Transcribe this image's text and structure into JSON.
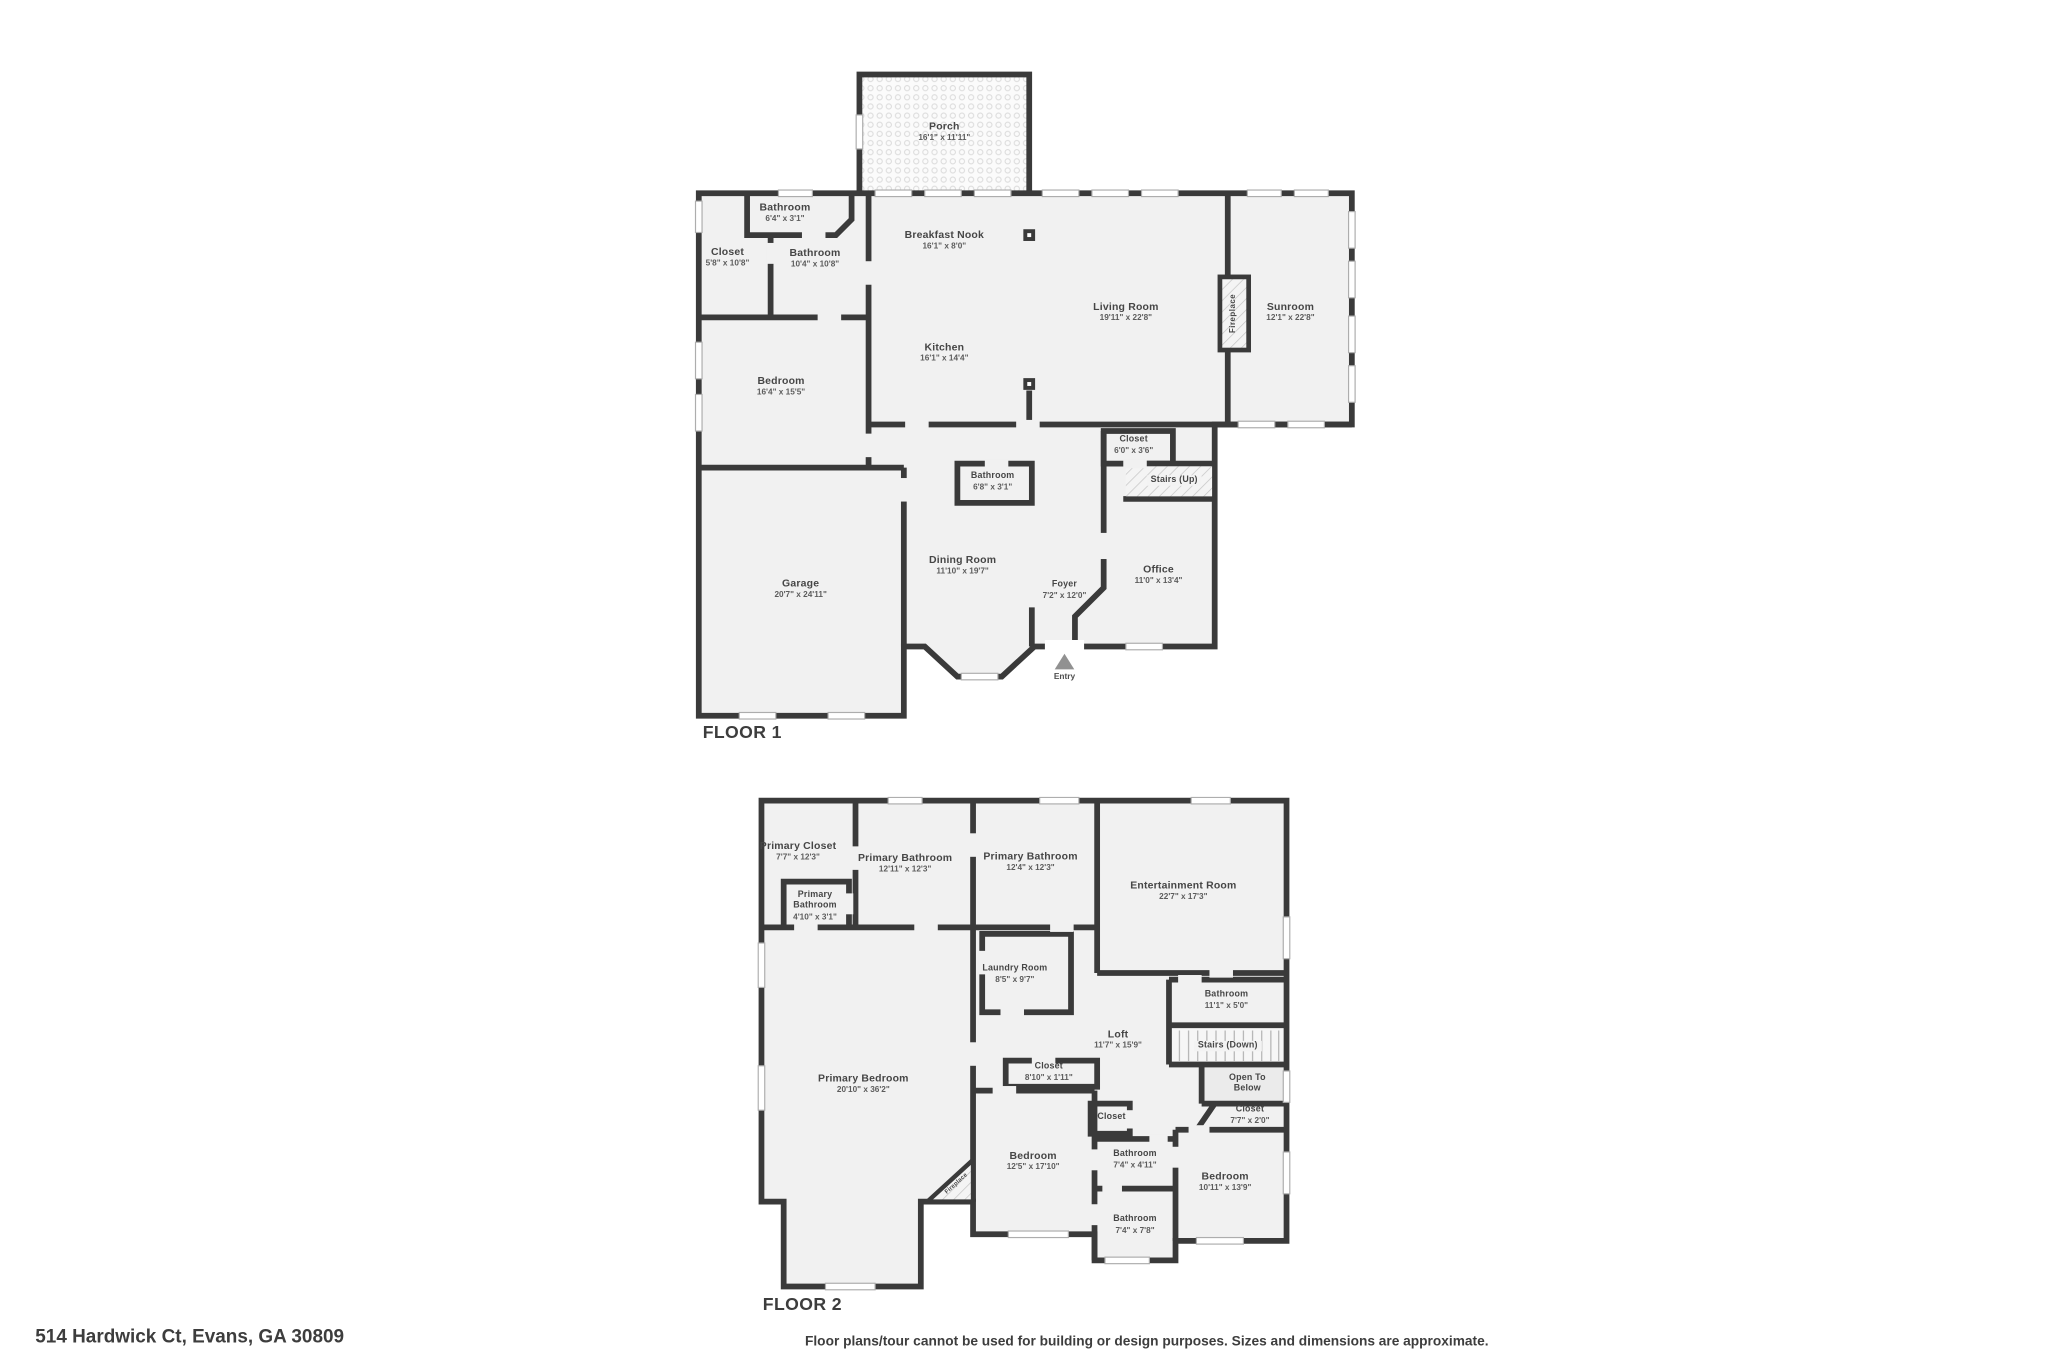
{
  "page": {
    "address": "514 Hardwick Ct, Evans, GA 30809",
    "disclaimer": "Floor plans/tour cannot be used for building or design purposes. Sizes and dimensions are approximate."
  },
  "colors": {
    "wall": "#3a3a3a",
    "floor_fill": "#f1f1f1",
    "label_text": "#464646",
    "entry_marker": "#919191"
  },
  "icons": {
    "entry_marker": "up-triangle",
    "column_marker": "filled-square",
    "fireplace_fill": "diagonal-hatch",
    "porch_fill": "dot-pattern"
  },
  "floor1": {
    "label": "FLOOR 1",
    "entry": "Entry",
    "rooms": [
      {
        "name": "Porch",
        "dims": "16'1\" x 11'11\""
      },
      {
        "name": "Bathroom",
        "dims": "6'4\" x 3'1\""
      },
      {
        "name": "Closet",
        "dims": "5'8\" x 10'8\""
      },
      {
        "name": "Bathroom",
        "dims": "10'4\" x 10'8\""
      },
      {
        "name": "Breakfast Nook",
        "dims": "16'1\" x 8'0\""
      },
      {
        "name": "Living Room",
        "dims": "19'11\" x 22'8\""
      },
      {
        "name": "Sunroom",
        "dims": "12'1\" x 22'8\""
      },
      {
        "name": "Fireplace",
        "dims": ""
      },
      {
        "name": "Bedroom",
        "dims": "16'4\" x 15'5\""
      },
      {
        "name": "Kitchen",
        "dims": "16'1\" x 14'4\""
      },
      {
        "name": "Closet",
        "dims": "6'0\" x 3'6\""
      },
      {
        "name": "Stairs (Up)",
        "dims": ""
      },
      {
        "name": "Bathroom",
        "dims": "6'8\" x 3'1\""
      },
      {
        "name": "Garage",
        "dims": "20'7\" x 24'11\""
      },
      {
        "name": "Dining Room",
        "dims": "11'10\" x 19'7\""
      },
      {
        "name": "Foyer",
        "dims": "7'2\" x 12'0\""
      },
      {
        "name": "Office",
        "dims": "11'0\" x 13'4\""
      }
    ]
  },
  "floor2": {
    "label": "FLOOR 2",
    "rooms": [
      {
        "name": "Primary Closet",
        "dims": "7'7\" x 12'3\""
      },
      {
        "name": "Primary Bathroom",
        "dims": "12'11\" x 12'3\""
      },
      {
        "name": "Primary Bathroom",
        "dims": "12'4\" x 12'3\""
      },
      {
        "name": "Entertainment Room",
        "dims": "22'7\" x 17'3\""
      },
      {
        "name": "Primary Bathroom",
        "dims": "4'10\" x 3'1\""
      },
      {
        "name": "Laundry Room",
        "dims": "8'5\" x 9'7\""
      },
      {
        "name": "Bathroom",
        "dims": "11'1\" x 5'0\""
      },
      {
        "name": "Loft",
        "dims": "11'7\" x 15'9\""
      },
      {
        "name": "Stairs (Down)",
        "dims": ""
      },
      {
        "name": "Open To Below",
        "dims": ""
      },
      {
        "name": "Closet",
        "dims": "8'10\" x 1'11\""
      },
      {
        "name": "Closet",
        "dims": "7'7\" x 2'0\""
      },
      {
        "name": "Closet",
        "dims": ""
      },
      {
        "name": "Primary Bedroom",
        "dims": "20'10\" x 36'2\""
      },
      {
        "name": "Bedroom",
        "dims": "12'5\" x 17'10\""
      },
      {
        "name": "Bathroom",
        "dims": "7'4\" x 4'11\""
      },
      {
        "name": "Bathroom",
        "dims": "7'4\" x 7'8\""
      },
      {
        "name": "Bedroom",
        "dims": "10'11\" x 13'9\""
      },
      {
        "name": "Fireplace",
        "dims": ""
      }
    ]
  }
}
